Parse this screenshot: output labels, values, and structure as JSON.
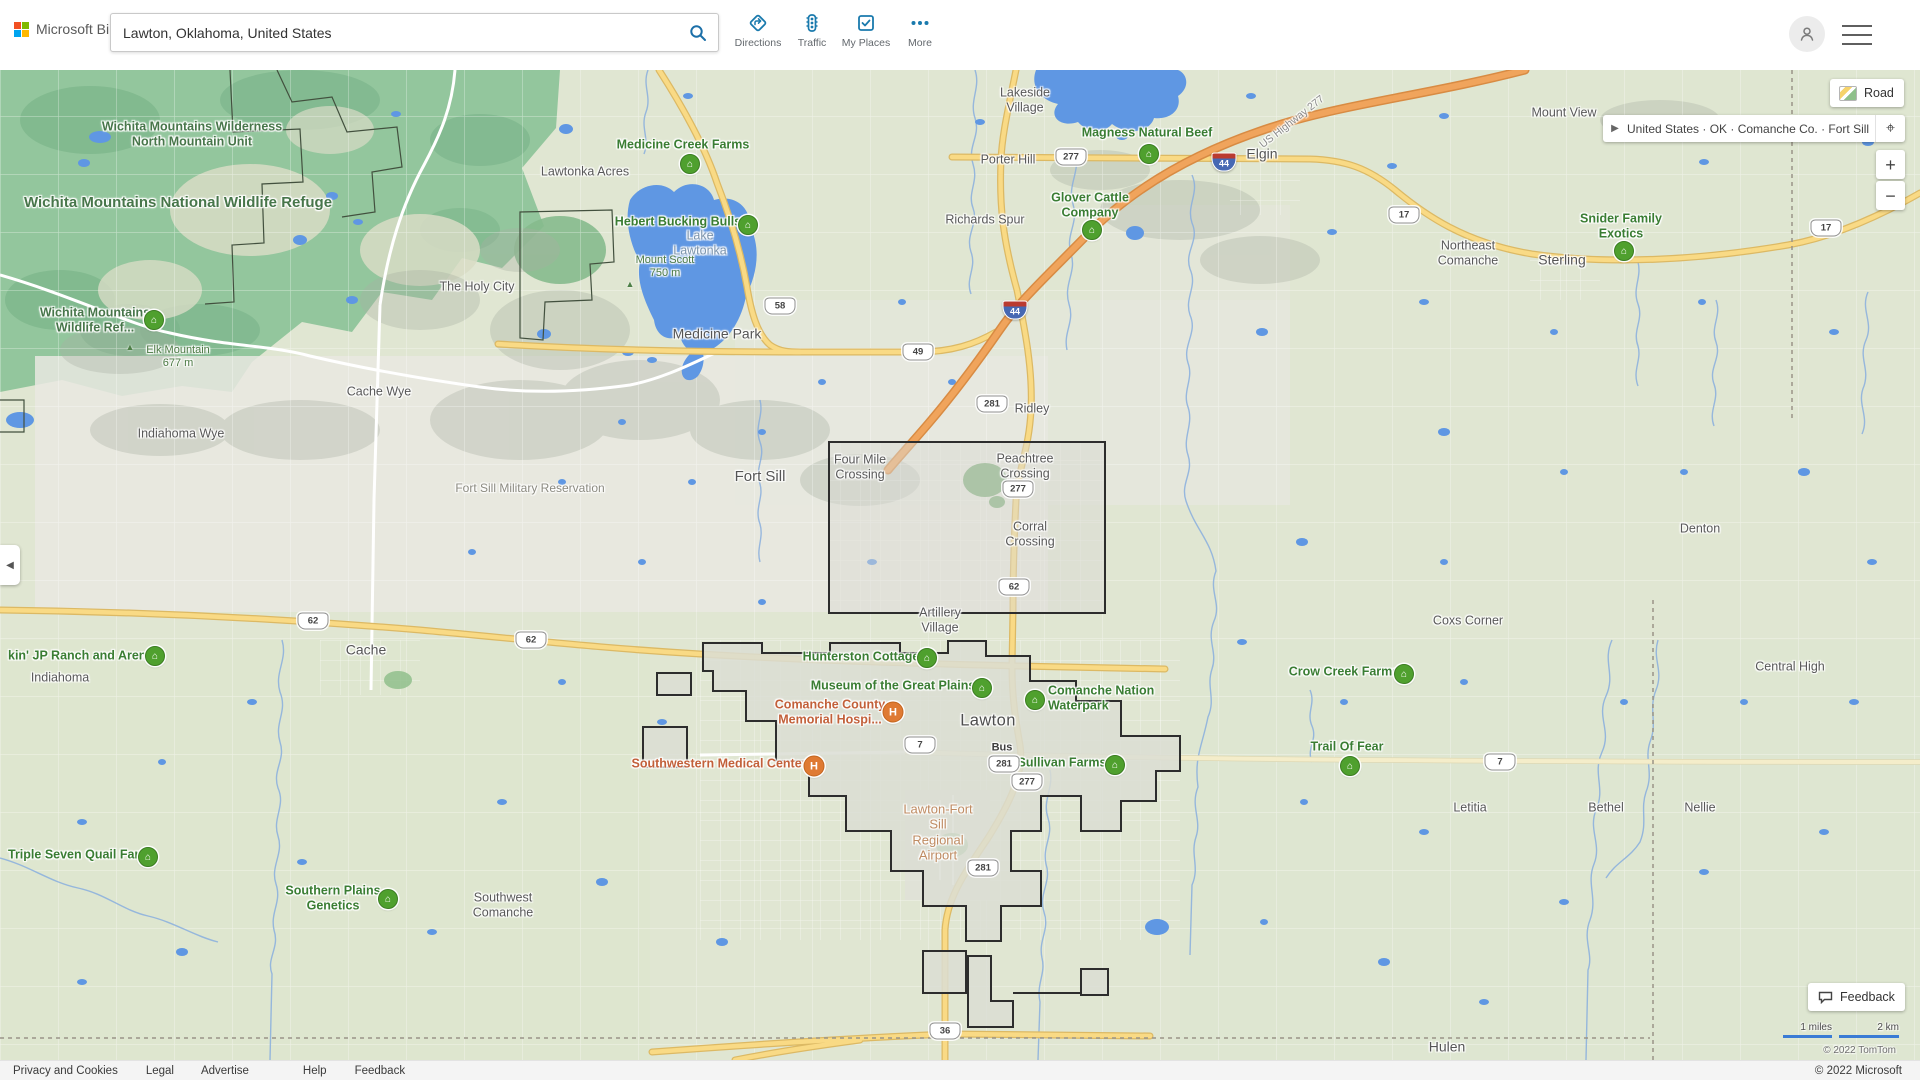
{
  "header": {
    "brand": "Microsoft Bing",
    "search": {
      "value": "Lawton, Oklahoma, United States",
      "placeholder": ""
    },
    "toolbar": [
      "Directions",
      "Traffic",
      "My Places",
      "More"
    ]
  },
  "controls": {
    "map_style": "Road",
    "breadcrumb": "United States · OK · Comanche Co. · Fort Sill",
    "zoom_in": "+",
    "zoom_out": "−",
    "feedback": "Feedback",
    "scale_miles": "1 miles",
    "scale_km": "2 km",
    "map_copyright": "© 2022 TomTom"
  },
  "footer": {
    "links": [
      "Privacy and Cookies",
      "Legal",
      "Advertise",
      "Help",
      "Feedback"
    ],
    "copyright": "© 2022 Microsoft"
  },
  "map": {
    "labels": [
      {
        "t": "Lakeside\nVillage",
        "x": 1025,
        "y": 100,
        "cls": "town"
      },
      {
        "t": "Porter Hill",
        "x": 1008,
        "y": 160,
        "cls": "town"
      },
      {
        "t": "Mount View",
        "x": 1564,
        "y": 113,
        "cls": "town"
      },
      {
        "t": "Lawtonka Acres",
        "x": 585,
        "y": 172,
        "cls": "town"
      },
      {
        "t": "Richards Spur",
        "x": 985,
        "y": 220,
        "cls": "town"
      },
      {
        "t": "Elgin",
        "x": 1262,
        "y": 154,
        "cls": "town-md"
      },
      {
        "t": "Northeast\nComanche",
        "x": 1468,
        "y": 253,
        "cls": "town"
      },
      {
        "t": "Sterling",
        "x": 1562,
        "y": 260,
        "cls": "town-md"
      },
      {
        "t": "The Holy City",
        "x": 477,
        "y": 287,
        "cls": "town"
      },
      {
        "t": "Medicine Park",
        "x": 717,
        "y": 334,
        "cls": "town-md"
      },
      {
        "t": "Cache Wye",
        "x": 379,
        "y": 392,
        "cls": "town"
      },
      {
        "t": "Ridley",
        "x": 1032,
        "y": 409,
        "cls": "town"
      },
      {
        "t": "Indiahoma Wye",
        "x": 181,
        "y": 434,
        "cls": "town"
      },
      {
        "t": "Four Mile\nCrossing",
        "x": 860,
        "y": 467,
        "cls": "town"
      },
      {
        "t": "Peachtree\nCrossing",
        "x": 1025,
        "y": 466,
        "cls": "town"
      },
      {
        "t": "Fort Sill",
        "x": 760,
        "y": 477,
        "cls": "town-lg"
      },
      {
        "t": "Denton",
        "x": 1700,
        "y": 529,
        "cls": "town"
      },
      {
        "t": "Corral\nCrossing",
        "x": 1030,
        "y": 534,
        "cls": "town"
      },
      {
        "t": "Artillery\nVillage",
        "x": 940,
        "y": 620,
        "cls": "town"
      },
      {
        "t": "Coxs Corner",
        "x": 1468,
        "y": 621,
        "cls": "town"
      },
      {
        "t": "Cache",
        "x": 366,
        "y": 650,
        "cls": "town-md"
      },
      {
        "t": "Central High",
        "x": 1790,
        "y": 667,
        "cls": "town"
      },
      {
        "t": "Indiahoma",
        "x": 60,
        "y": 678,
        "cls": "town"
      },
      {
        "t": "Lawton",
        "x": 988,
        "y": 721,
        "cls": "city"
      },
      {
        "t": "Letitia",
        "x": 1470,
        "y": 808,
        "cls": "town"
      },
      {
        "t": "Bethel",
        "x": 1606,
        "y": 808,
        "cls": "town"
      },
      {
        "t": "Nellie",
        "x": 1700,
        "y": 808,
        "cls": "town"
      },
      {
        "t": "Southwest\nComanche",
        "x": 503,
        "y": 905,
        "cls": "town"
      },
      {
        "t": "Hulen",
        "x": 1447,
        "y": 1047,
        "cls": "town-md"
      },
      {
        "t": "Fort Sill Military Reservation",
        "x": 530,
        "y": 488,
        "cls": "resv"
      },
      {
        "t": "Lake\nLawtonka",
        "x": 700,
        "y": 243,
        "cls": "water"
      },
      {
        "t": "Mount Scott\n750 m",
        "x": 665,
        "y": 267,
        "cls": "peak-label"
      },
      {
        "t": "Elk Mountain\n677 m",
        "x": 178,
        "y": 357,
        "cls": "peak-label"
      },
      {
        "t": "Wichita Mountains Wilderness\nNorth Mountain Unit",
        "x": 192,
        "y": 134,
        "cls": "park"
      },
      {
        "t": "Wichita Mountains National Wildlife Refuge",
        "x": 178,
        "y": 203,
        "cls": "park-lg"
      },
      {
        "t": "Wichita Mountains\nWildlife Ref...",
        "x": 95,
        "y": 320,
        "cls": "park"
      },
      {
        "t": "US Highway 277",
        "x": 1292,
        "y": 122,
        "cls": "road-name",
        "rot": -38
      },
      {
        "t": "Bus",
        "x": 1002,
        "y": 748,
        "cls": "bus"
      },
      {
        "t": "Medicine Creek Farms",
        "x": 683,
        "y": 145,
        "cls": "poi"
      },
      {
        "t": "Hebert Bucking Bulls",
        "x": 678,
        "y": 222,
        "cls": "poi"
      },
      {
        "t": "Magness Natural Beef",
        "x": 1147,
        "y": 133,
        "cls": "poi"
      },
      {
        "t": "Glover Cattle\nCompany",
        "x": 1090,
        "y": 205,
        "cls": "poi"
      },
      {
        "t": "Snider Family\nExotics",
        "x": 1621,
        "y": 226,
        "cls": "poi"
      },
      {
        "t": "kin' JP Ranch and Arena",
        "x": 8,
        "y": 656,
        "cls": "poi",
        "align": "left"
      },
      {
        "t": "Hunterston Cottage",
        "x": 861,
        "y": 657,
        "cls": "poi"
      },
      {
        "t": "Crow Creek Farms",
        "x": 1344,
        "y": 672,
        "cls": "poi"
      },
      {
        "t": "Museum of the Great Plains",
        "x": 893,
        "y": 686,
        "cls": "poi"
      },
      {
        "t": "Comanche Nation\nWaterpark",
        "x": 1048,
        "y": 698,
        "cls": "poi",
        "align": "left"
      },
      {
        "t": "Sullivan Farms",
        "x": 1062,
        "y": 763,
        "cls": "poi"
      },
      {
        "t": "Trail Of Fear",
        "x": 1347,
        "y": 747,
        "cls": "poi"
      },
      {
        "t": "Triple Seven Quail Farm",
        "x": 8,
        "y": 855,
        "cls": "poi",
        "align": "left"
      },
      {
        "t": "Southern Plains\nGenetics",
        "x": 333,
        "y": 898,
        "cls": "poi"
      },
      {
        "t": "Comanche County\nMemorial Hospi...",
        "x": 830,
        "y": 712,
        "cls": "med"
      },
      {
        "t": "Southwestern Medical Center",
        "x": 719,
        "y": 764,
        "cls": "med"
      },
      {
        "t": "Lawton-Fort\nSill\nRegional\nAirport",
        "x": 938,
        "y": 832,
        "cls": "airport"
      }
    ],
    "markers": [
      {
        "x": 690,
        "y": 164,
        "kind": "farm"
      },
      {
        "x": 748,
        "y": 225,
        "kind": "farm"
      },
      {
        "x": 1149,
        "y": 154,
        "kind": "farm"
      },
      {
        "x": 1092,
        "y": 230,
        "kind": "farm"
      },
      {
        "x": 1624,
        "y": 251,
        "kind": "farm"
      },
      {
        "x": 155,
        "y": 656,
        "kind": "farm"
      },
      {
        "x": 927,
        "y": 658,
        "kind": "farm"
      },
      {
        "x": 1404,
        "y": 674,
        "kind": "farm"
      },
      {
        "x": 982,
        "y": 688,
        "kind": "farm"
      },
      {
        "x": 1035,
        "y": 700,
        "kind": "farm"
      },
      {
        "x": 1115,
        "y": 765,
        "kind": "farm"
      },
      {
        "x": 1350,
        "y": 766,
        "kind": "farm"
      },
      {
        "x": 148,
        "y": 857,
        "kind": "farm"
      },
      {
        "x": 388,
        "y": 899,
        "kind": "farm"
      },
      {
        "x": 154,
        "y": 320,
        "kind": "farm"
      },
      {
        "x": 893,
        "y": 712,
        "kind": "hospital"
      },
      {
        "x": 814,
        "y": 766,
        "kind": "hospital"
      },
      {
        "x": 630,
        "y": 284,
        "kind": "peak"
      },
      {
        "x": 130,
        "y": 347,
        "kind": "peak"
      }
    ],
    "shields": [
      {
        "t": "277",
        "x": 1071,
        "y": 157,
        "kind": "us"
      },
      {
        "t": "58",
        "x": 780,
        "y": 306,
        "kind": "us"
      },
      {
        "t": "49",
        "x": 918,
        "y": 352,
        "kind": "us"
      },
      {
        "t": "281",
        "x": 992,
        "y": 404,
        "kind": "us"
      },
      {
        "t": "277",
        "x": 1018,
        "y": 489,
        "kind": "us"
      },
      {
        "t": "62",
        "x": 1014,
        "y": 587,
        "kind": "us"
      },
      {
        "t": "62",
        "x": 313,
        "y": 621,
        "kind": "us"
      },
      {
        "t": "62",
        "x": 531,
        "y": 640,
        "kind": "us"
      },
      {
        "t": "17",
        "x": 1404,
        "y": 215,
        "kind": "us"
      },
      {
        "t": "17",
        "x": 1826,
        "y": 228,
        "kind": "us"
      },
      {
        "t": "7",
        "x": 920,
        "y": 745,
        "kind": "us"
      },
      {
        "t": "7",
        "x": 1500,
        "y": 762,
        "kind": "us"
      },
      {
        "t": "281",
        "x": 1004,
        "y": 764,
        "kind": "us"
      },
      {
        "t": "277",
        "x": 1027,
        "y": 782,
        "kind": "us"
      },
      {
        "t": "281",
        "x": 983,
        "y": 868,
        "kind": "us"
      },
      {
        "t": "36",
        "x": 945,
        "y": 1031,
        "kind": "us"
      },
      {
        "t": "44",
        "x": 1224,
        "y": 162,
        "kind": "interstate"
      },
      {
        "t": "44",
        "x": 1015,
        "y": 310,
        "kind": "interstate"
      }
    ]
  }
}
